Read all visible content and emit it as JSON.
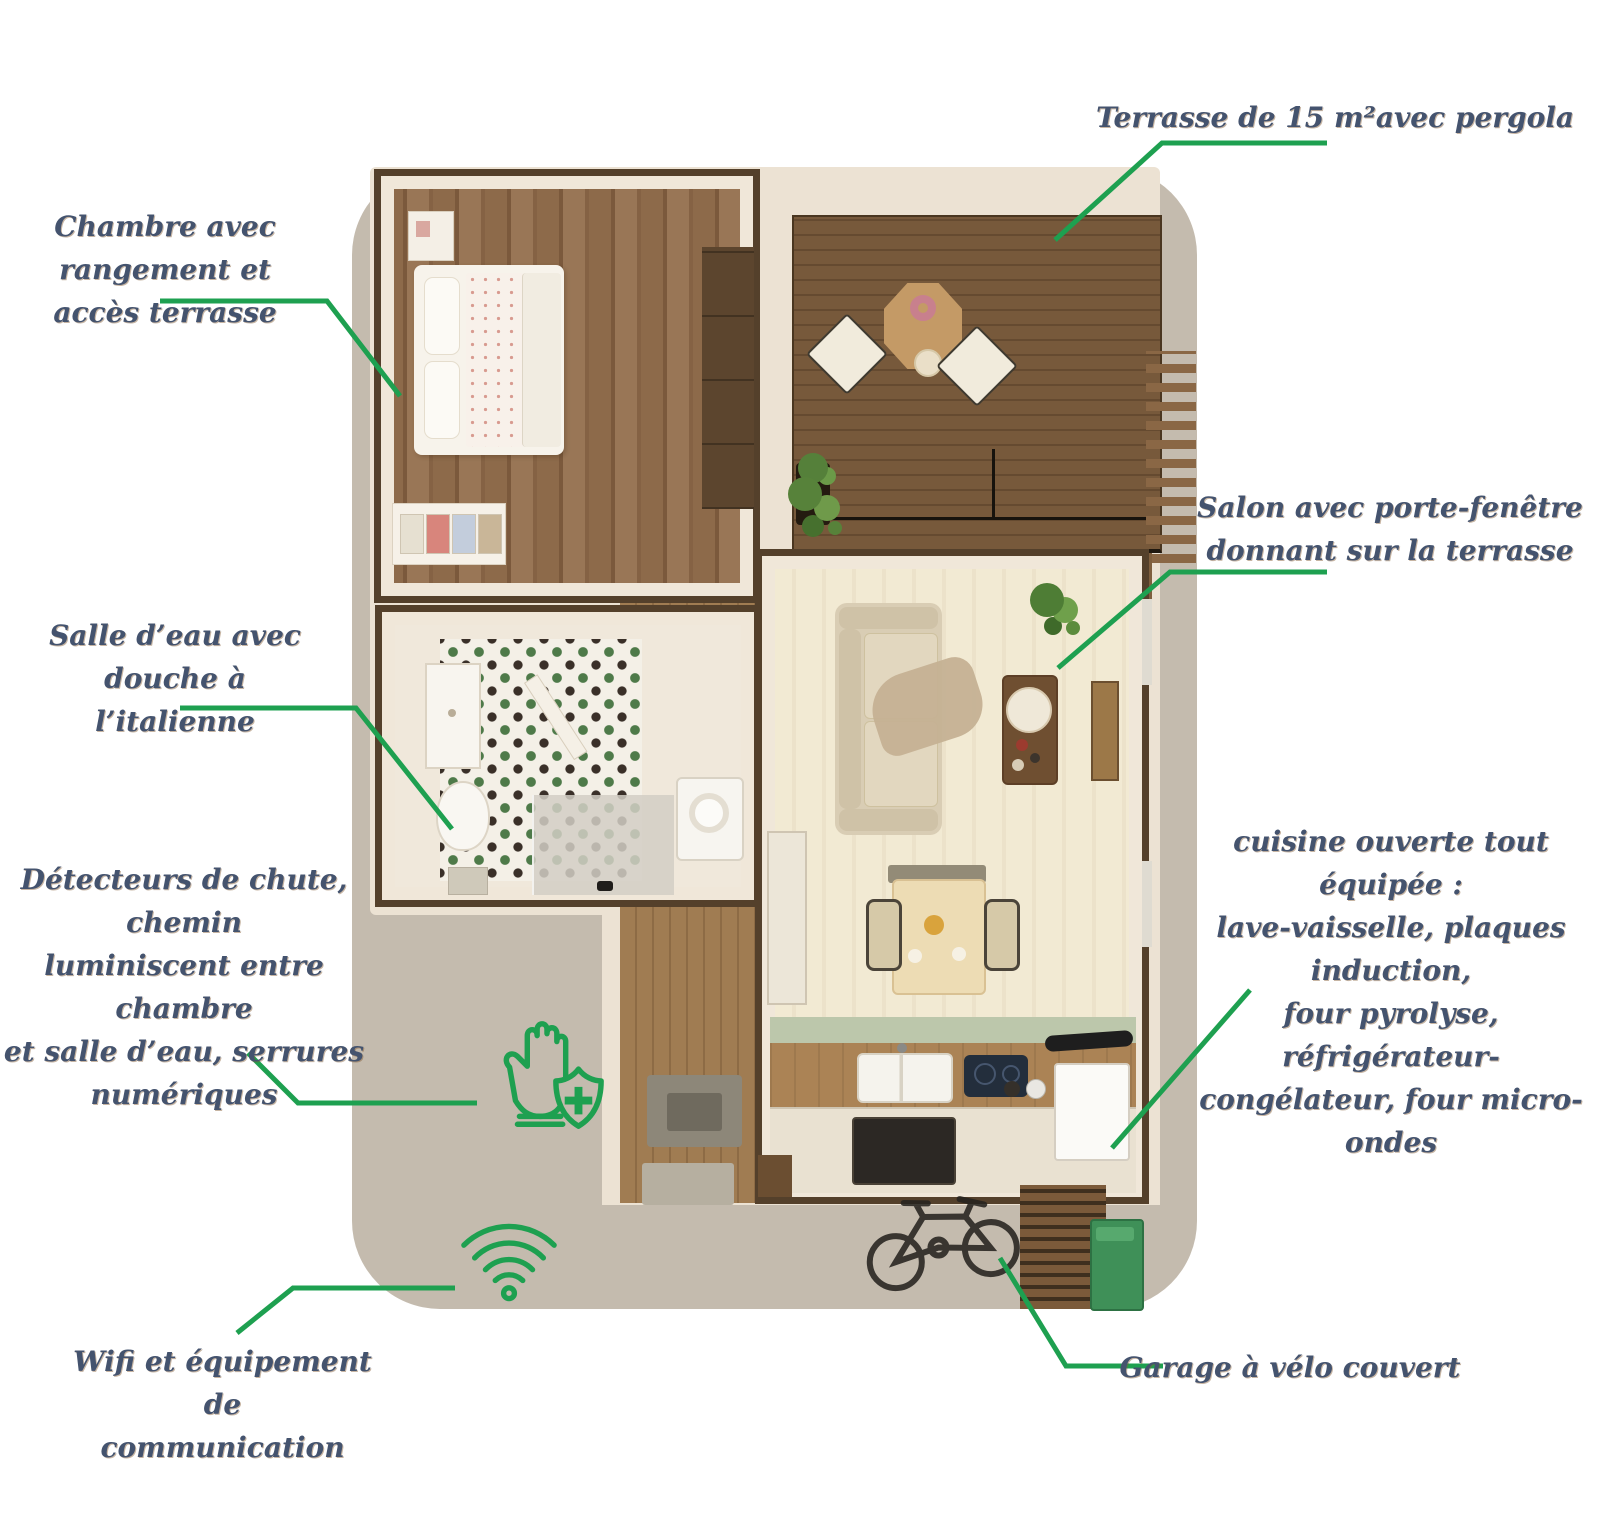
{
  "panel": {
    "background": "#c4bbae"
  },
  "colors": {
    "annotation_green": "#1ea050",
    "label_text": "#44536e",
    "page_background": "#ffffff"
  },
  "labels": {
    "terrace": {
      "lines": [
        "Terrasse de 15 m²avec pergola"
      ]
    },
    "bedroom": {
      "lines": [
        "Chambre avec rangement et",
        "accès terrasse"
      ]
    },
    "living_room": {
      "lines": [
        "Salon avec porte-fenêtre",
        "donnant sur la terrasse"
      ]
    },
    "bathroom": {
      "lines": [
        "Salle d’eau avec douche à",
        "l’italienne"
      ]
    },
    "safety": {
      "lines": [
        "Détecteurs de chute, chemin",
        "luminiscent entre chambre",
        "et salle d’eau, serrures",
        "numériques"
      ]
    },
    "kitchen": {
      "lines": [
        "cuisine ouverte tout équipée  :",
        "lave-vaisselle, plaques induction,",
        "four pyrolyse, réfrigérateur-",
        "congélateur, four micro-ondes"
      ]
    },
    "wifi": {
      "lines": [
        "Wifi et équipement de",
        "communication"
      ]
    },
    "bike_garage": {
      "lines": [
        "Garage à vélo couvert"
      ]
    }
  },
  "icons": {
    "safety": "hand-shield-icon",
    "wifi": "wifi-icon"
  }
}
